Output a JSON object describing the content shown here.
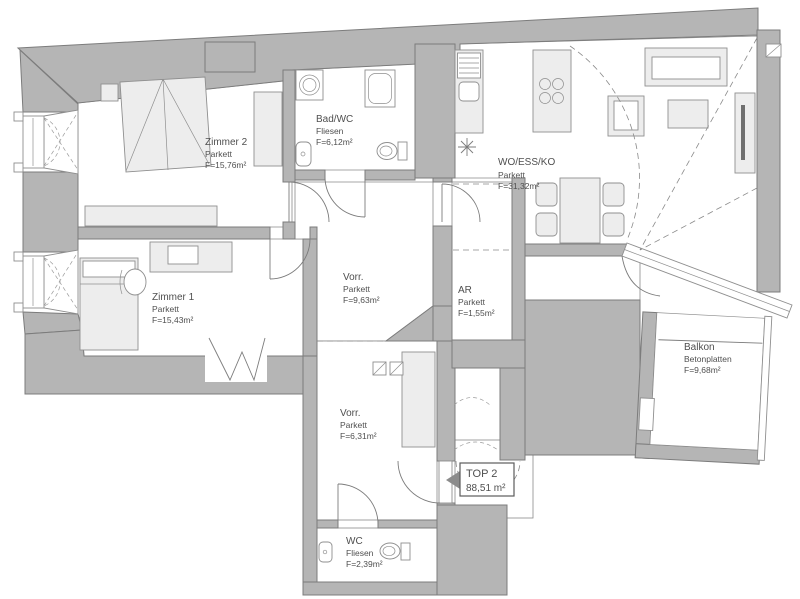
{
  "document": {
    "type": "apartment floor plan",
    "unit": {
      "name": "TOP 2",
      "area": "88,51 m²"
    }
  },
  "rooms": {
    "zimmer2": {
      "name": "Zimmer 2",
      "material": "Parkett",
      "area": "F=15,76m²"
    },
    "bad_wc": {
      "name": "Bad/WC",
      "material": "Fliesen",
      "area": "F=6,12m²"
    },
    "wo_ess_ko": {
      "name": "WO/ESS/KO",
      "material": "Parkett",
      "area": "F=31,32m²"
    },
    "zimmer1": {
      "name": "Zimmer 1",
      "material": "Parkett",
      "area": "F=15,43m²"
    },
    "vorraum_1": {
      "name": "Vorr.",
      "material": "Parkett",
      "area": "F=9,63m²"
    },
    "abstellraum": {
      "name": "AR",
      "material": "Parkett",
      "area": "F=1,55m²"
    },
    "vorraum_2": {
      "name": "Vorr.",
      "material": "Parkett",
      "area": "F=6,31m²"
    },
    "wc": {
      "name": "WC",
      "material": "Fliesen",
      "area": "F=2,39m²"
    },
    "balkon": {
      "name": "Balkon",
      "material": "Betonplatten",
      "area": "F=9,68m²"
    }
  },
  "colors": {
    "wall": "#b5b5b5",
    "wall_outline": "#7c7c7c",
    "furniture_fill": "#ededed",
    "line": "#7c7c7c",
    "text": "#4f4f4f",
    "background": "#ffffff"
  }
}
